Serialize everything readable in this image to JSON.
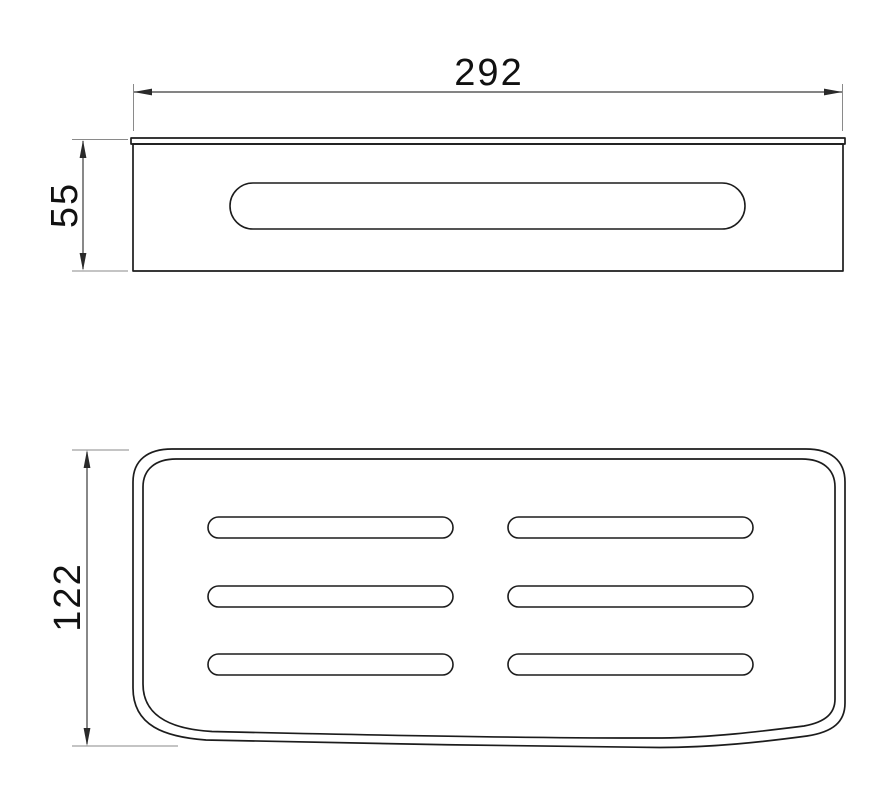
{
  "page": {
    "background_color": "#ffffff",
    "line_color": "#1c1c1c"
  },
  "drawing": {
    "type": "technical-dimension-drawing",
    "views": {
      "front_view": {
        "slot_count": 1,
        "has_top_rim": true
      },
      "top_view": {
        "slot_rows": 3,
        "slot_columns": 2,
        "border_style": "double-line rounded outline"
      }
    },
    "dimensions": [
      {
        "id": "width",
        "label": "292",
        "orientation": "horizontal"
      },
      {
        "id": "height",
        "label": "55",
        "orientation": "vertical"
      },
      {
        "id": "depth",
        "label": "122",
        "orientation": "vertical"
      }
    ]
  }
}
